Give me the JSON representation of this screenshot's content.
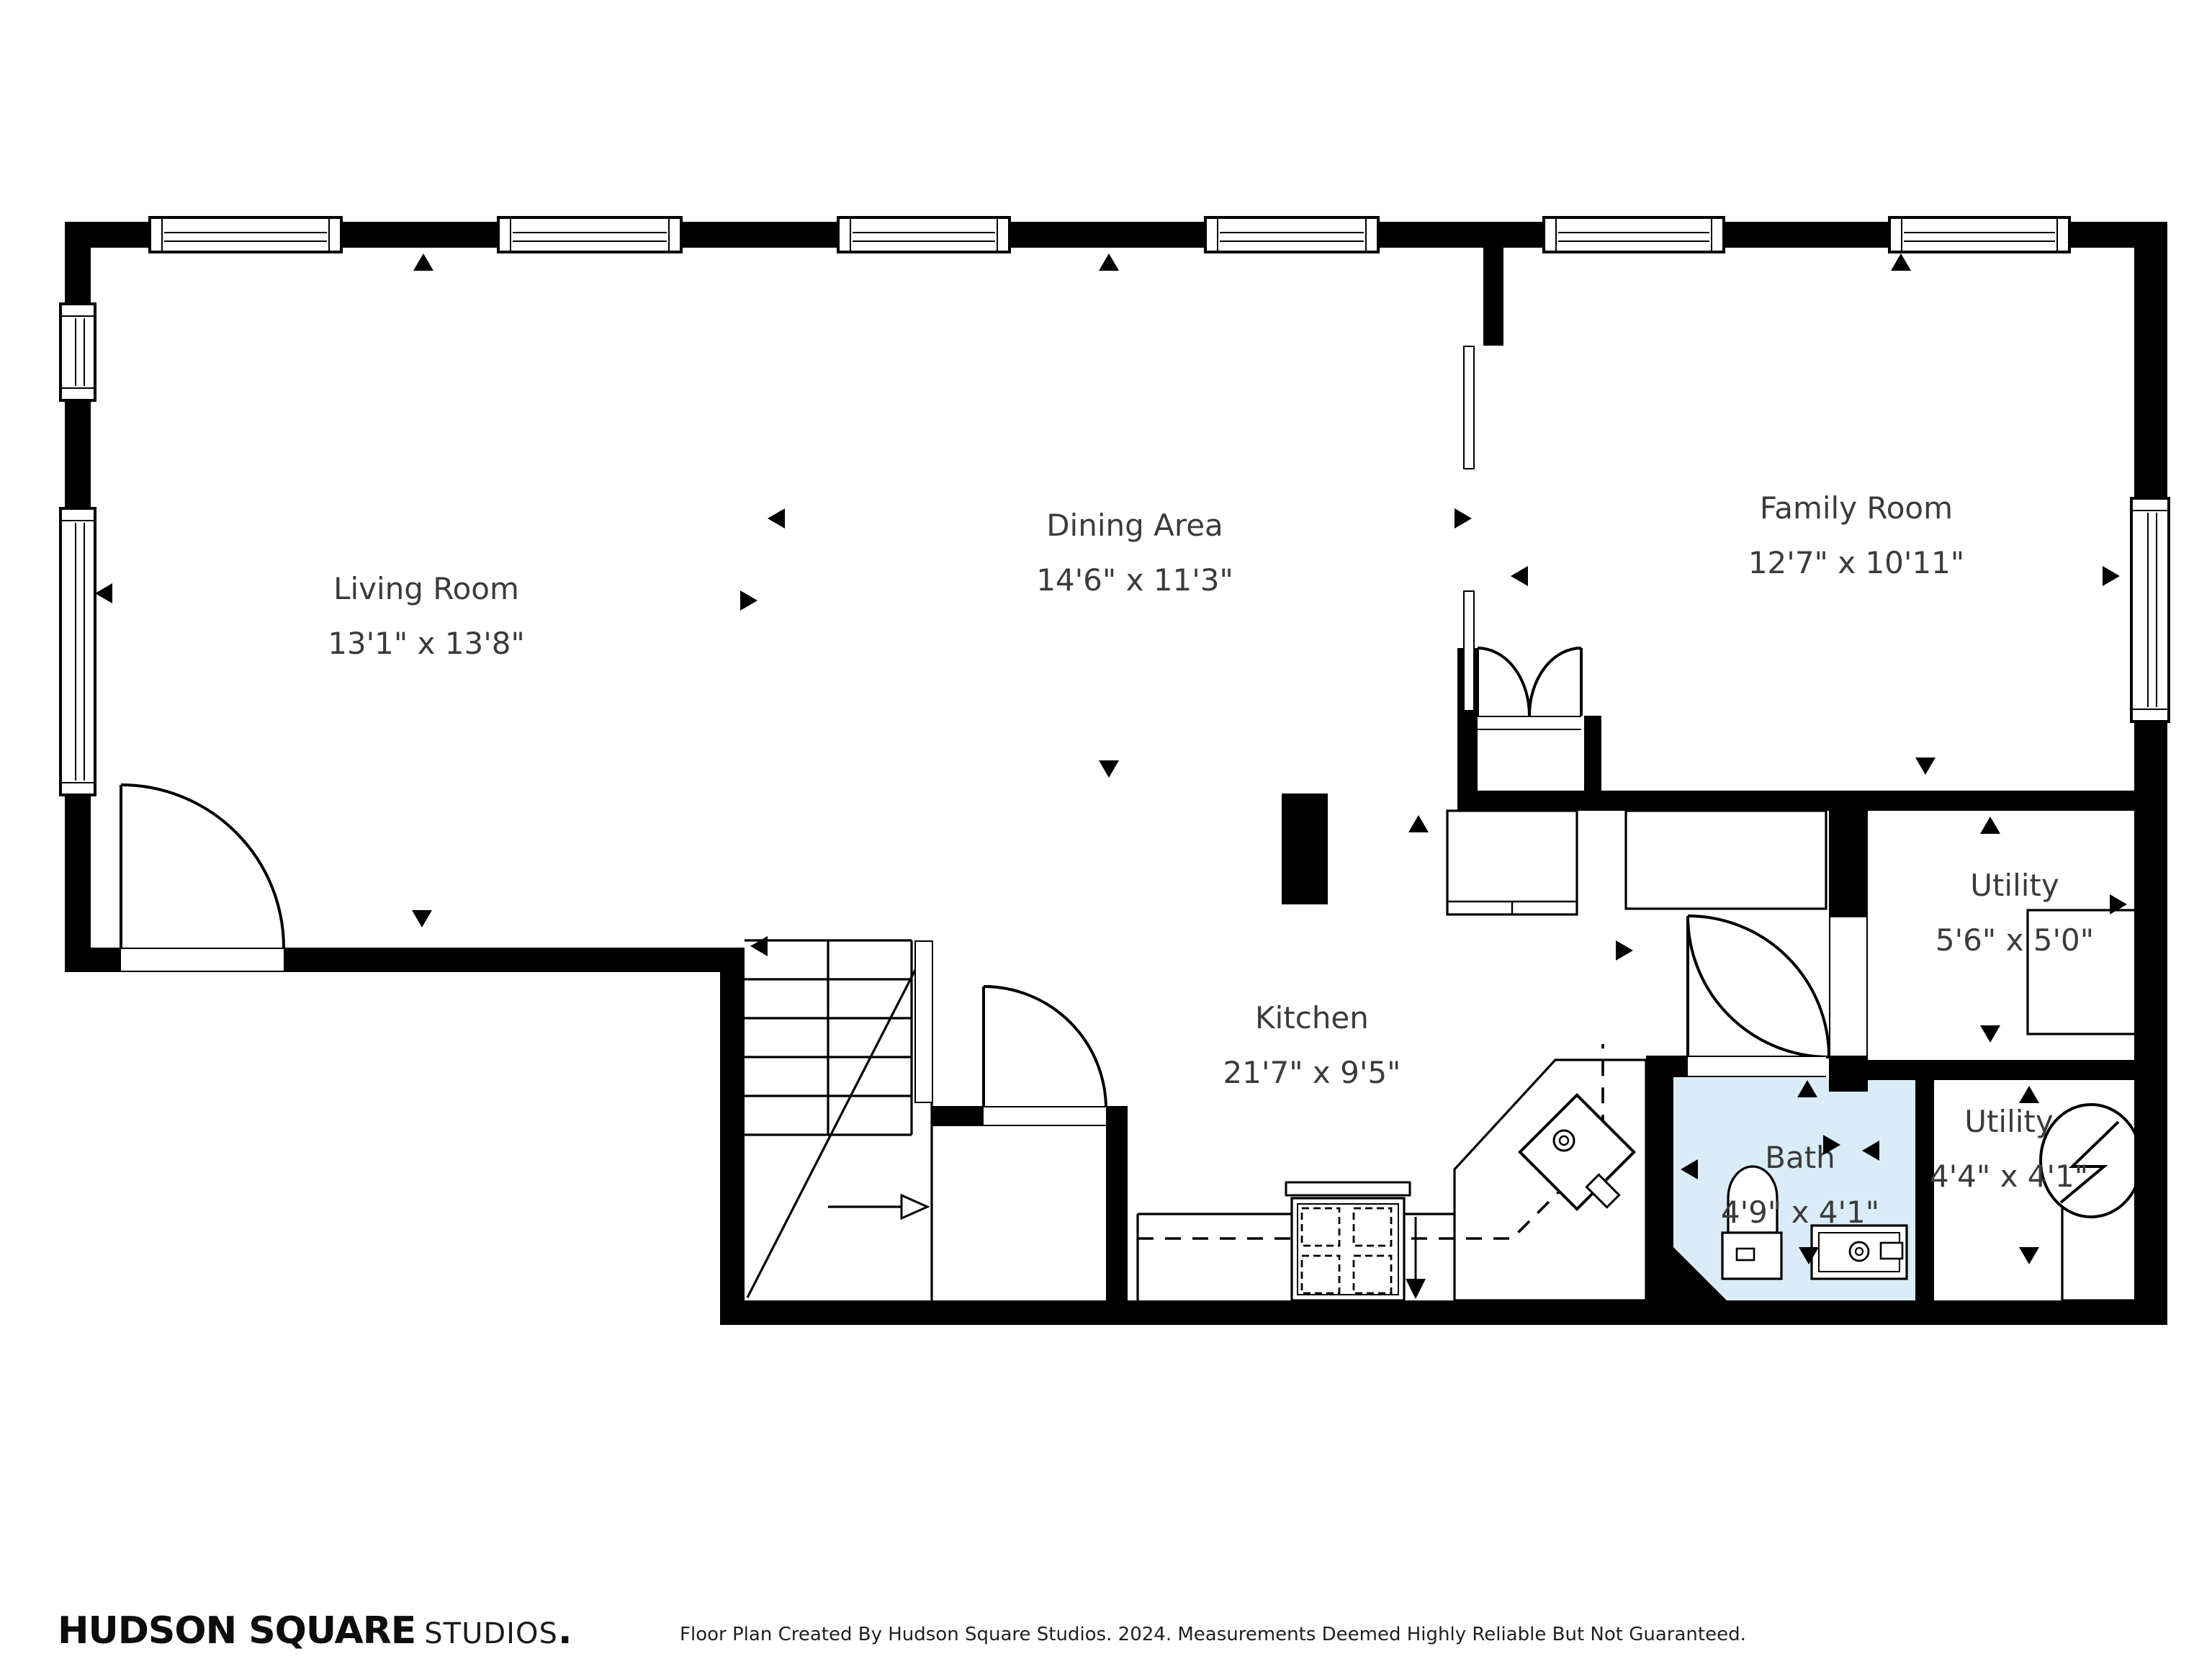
{
  "plan": {
    "rooms": [
      {
        "name": "Living Room",
        "dims": "13'1\" x 13'8\""
      },
      {
        "name": "Dining Area",
        "dims": "14'6\" x 11'3\""
      },
      {
        "name": "Family Room",
        "dims": "12'7\" x 10'11\""
      },
      {
        "name": "Kitchen",
        "dims": "21'7\" x 9'5\""
      },
      {
        "name": "Utility",
        "dims": "5'6\" x 5'0\""
      },
      {
        "name": "Bath",
        "dims": "4'9\" x 4'1\""
      },
      {
        "name": "Utility",
        "dims": "4'4\" x 4'1\""
      }
    ],
    "colors": {
      "wall": "#000000",
      "bath_floor": "#daecf8",
      "label_text": "#3b3b3b"
    }
  },
  "footer": {
    "brand_primary": "HUDSON SQUARE",
    "brand_secondary": "STUDIOS",
    "brand_period": ".",
    "disclaimer": "Floor Plan Created By Hudson Square Studios. 2024. Measurements Deemed Highly Reliable But Not Guaranteed."
  }
}
